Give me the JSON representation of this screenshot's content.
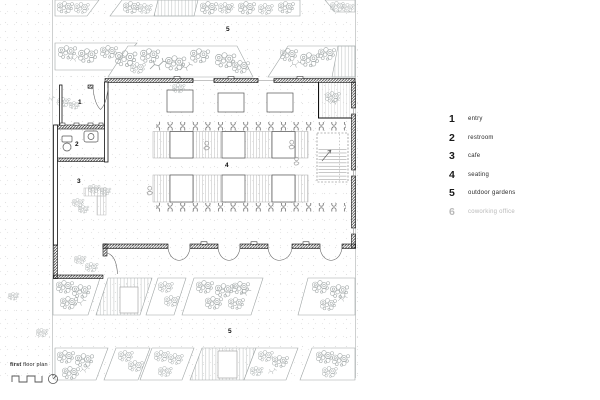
{
  "colors": {
    "ink": "#1a1a1a",
    "wall_hatch": "#333333",
    "sketch_gray": "#9aa0a0",
    "muted_text": "#b9b9b9",
    "paper": "#ffffff"
  },
  "plan": {
    "labels": [
      {
        "id": "entry",
        "text": "1"
      },
      {
        "id": "restroom",
        "text": "2"
      },
      {
        "id": "cafe",
        "text": "3"
      },
      {
        "id": "seating",
        "text": "4"
      },
      {
        "id": "outdoor-gardens-top",
        "text": "5"
      },
      {
        "id": "outdoor-gardens-bottom",
        "text": "5"
      }
    ]
  },
  "legend": {
    "items": [
      {
        "number": "1",
        "label": "entry",
        "muted": false
      },
      {
        "number": "2",
        "label": "restroom",
        "muted": false
      },
      {
        "number": "3",
        "label": "cafe",
        "muted": false
      },
      {
        "number": "4",
        "label": "seating",
        "muted": false
      },
      {
        "number": "5",
        "label": "outdoor gardens",
        "muted": false
      },
      {
        "number": "6",
        "label": "coworking office",
        "muted": true
      }
    ]
  },
  "title_block": {
    "title_bold": "first",
    "title_rest": " floor plan"
  }
}
